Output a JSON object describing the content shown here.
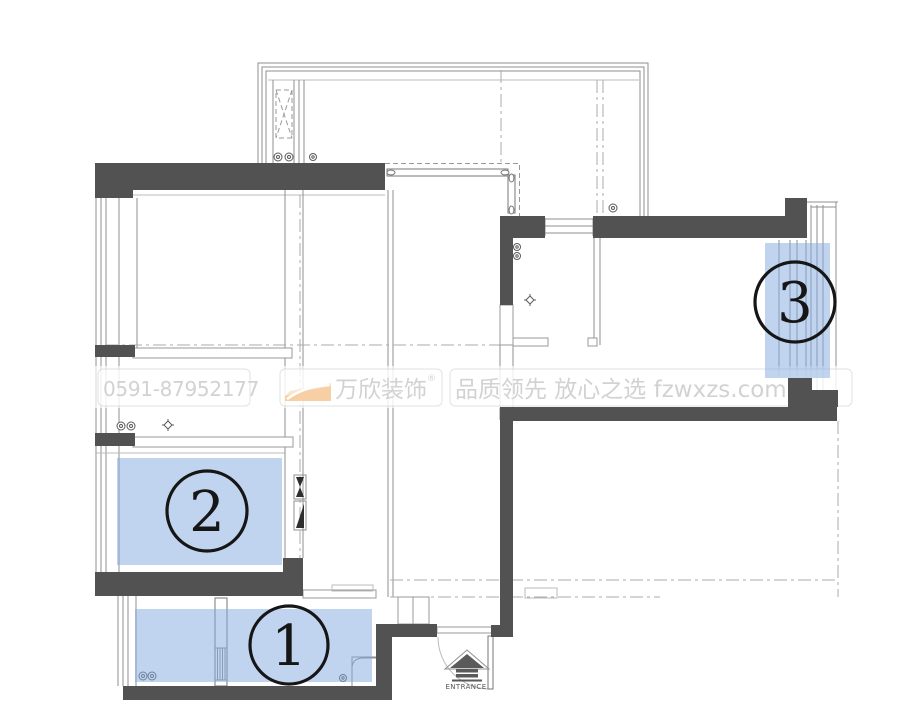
{
  "watermark": {
    "phone": "0591-87952177",
    "brand": "万欣装饰",
    "registered": "®",
    "slogan": "品质领先 放心之选 fzwxzs.com"
  },
  "entrance": {
    "label": "ENTRANCE"
  },
  "regions": [
    {
      "label": "1"
    },
    {
      "label": "2"
    },
    {
      "label": "3"
    }
  ],
  "colors": {
    "background": "#ffffff",
    "wall": "#525252",
    "line": "#8f8f8f",
    "dashdot": "#ababab",
    "highlight": "rgba(130,170,226,0.5)",
    "circle": "#161616",
    "watermark_text": "#d2d2d2",
    "logo_orange": "#f6cfa5",
    "logo_orange_light": "#fbe5ce",
    "entrance_arrow": "#5a5a5a"
  }
}
